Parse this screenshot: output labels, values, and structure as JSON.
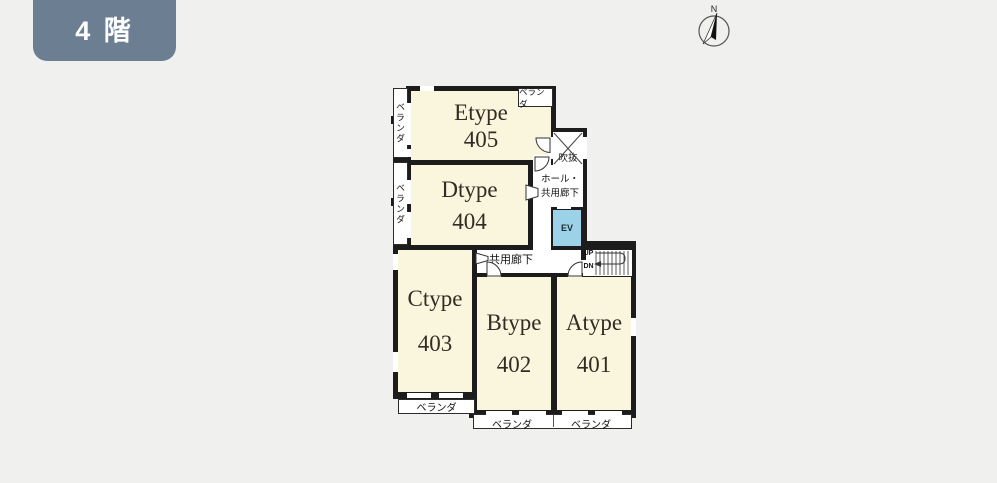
{
  "page": {
    "floor_badge": "4 階",
    "compass_n": "N"
  },
  "units": [
    {
      "name": "Etype",
      "number": "405"
    },
    {
      "name": "Dtype",
      "number": "404"
    },
    {
      "name": "Ctype",
      "number": "403"
    },
    {
      "name": "Btype",
      "number": "402"
    },
    {
      "name": "Atype",
      "number": "401"
    }
  ],
  "labels": {
    "balcony": "ベランダ",
    "hall": "ホール・",
    "hall2": "共用廊下",
    "corridor": "共用廊下",
    "void": "吹抜",
    "elevator": "EV",
    "up": "UP",
    "down": "DN"
  },
  "colors": {
    "background": "#f0f0ee",
    "wall": "#1c1c1c",
    "room_fill": "#faf5dd",
    "elevator_fill": "#9cd2e8",
    "badge_bg": "#6b7e92"
  }
}
